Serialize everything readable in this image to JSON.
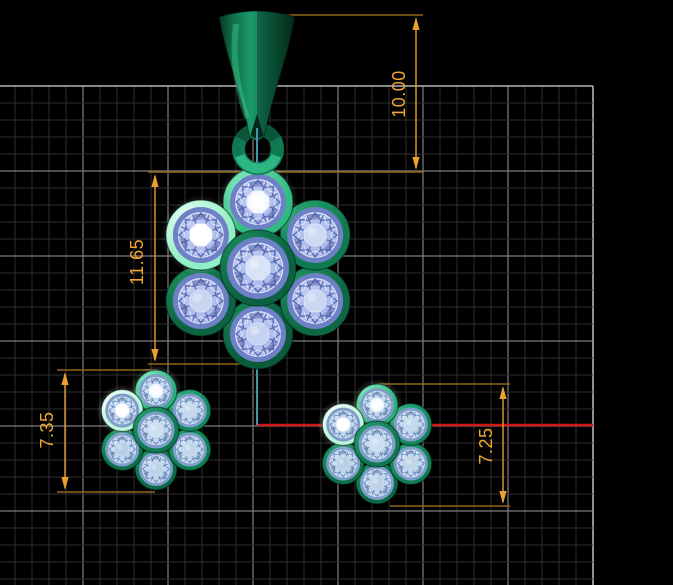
{
  "viewport": {
    "width": 673,
    "height": 585,
    "background": "#000000"
  },
  "grid": {
    "origin_x": -2,
    "origin_y": 86,
    "step": 17,
    "major_every": 5,
    "right_edge": 593,
    "bottom_edge": 585,
    "minor_color": "#2e2e2e",
    "major_color": "#7e7e7e",
    "edge_color": "#b4b4b4"
  },
  "annotations": {
    "dimension_color": "#e9a02c",
    "extension_color": "#8f691c",
    "text_color": "#f2a72f",
    "font_size": 18,
    "dimensions": [
      {
        "id": "bail-height",
        "label": "10.00",
        "line": {
          "x": 416,
          "y1": 17,
          "y2": 170
        },
        "extensions": [
          [
            270,
            15,
            423,
            15
          ]
        ],
        "text": {
          "x": 400,
          "y": 94
        }
      },
      {
        "id": "pendant-height",
        "label": "11.65",
        "line": {
          "x": 155,
          "y1": 174,
          "y2": 362
        },
        "extensions": [
          [
            148,
            172,
            423,
            172
          ],
          [
            148,
            364,
            259,
            364
          ]
        ],
        "text": {
          "x": 138,
          "y": 262
        }
      },
      {
        "id": "left-earring-height",
        "label": "7.35",
        "line": {
          "x": 65,
          "y1": 372,
          "y2": 490
        },
        "extensions": [
          [
            57,
            370,
            158,
            370
          ],
          [
            57,
            492,
            155,
            492
          ]
        ],
        "text": {
          "x": 48,
          "y": 430
        }
      },
      {
        "id": "right-earring-height",
        "label": "7.25",
        "line": {
          "x": 503,
          "y1": 386,
          "y2": 504
        },
        "extensions": [
          [
            377,
            384,
            510,
            384
          ],
          [
            390,
            506,
            510,
            506
          ]
        ],
        "text": {
          "x": 487,
          "y": 446
        }
      }
    ]
  },
  "construction": {
    "red_axis": {
      "x1": 257,
      "x2": 593,
      "y": 425,
      "color": "#d01818",
      "width": 2.4
    },
    "teal_color": "#3f97a8",
    "teal_width": 2,
    "teal_segments": [
      {
        "x": 257,
        "y1": 128,
        "y2": 163
      },
      {
        "x": 257,
        "y1": 366,
        "y2": 425
      }
    ]
  },
  "jewelry": {
    "pendant": {
      "bail": {
        "dark": "#06381f",
        "mid": "#0d6a47",
        "light": "#1b9a6c",
        "notch": "#03271a",
        "shade": "rgba(0,0,0,0.28)",
        "highlight": "rgba(80,220,160,0.35)"
      },
      "ring": {
        "cx": 258,
        "cy": 149,
        "radius": 19.5,
        "tube": 13,
        "base": "#0f7a52",
        "dark_arc": "#0a4c33",
        "light_arc": "#33c18c"
      },
      "palette": {
        "band_id": "band-P",
        "rim": "#6e80c6",
        "band": "#a3b4e8",
        "band_hi": "#bcc9f2",
        "web_dark": "#5a6cb2",
        "web_light": "rgba(238,243,255,0.85)",
        "web_shadow": "#46549e"
      },
      "flower": {
        "cx": 258,
        "cy": 268,
        "petal_distance": 66,
        "petal_bezel_r": 35,
        "petal_gem_r": 28,
        "center_bezel_r": 38,
        "center_gem_r": 31,
        "stones": [
          {
            "name": "bottom",
            "angle": 90,
            "bezel": "#0a5a3b",
            "bezel_hi": "#1c8a5c",
            "table": "#c6d3f0"
          },
          {
            "name": "bottom-right",
            "angle": 30,
            "bezel": "#0d6844",
            "bezel_hi": "#219663",
            "table": "#cbd7f2"
          },
          {
            "name": "bottom-left",
            "angle": 150,
            "bezel": "#0c6341",
            "bezel_hi": "#1f9160",
            "table": "#c9d5f1"
          },
          {
            "name": "top-right",
            "angle": -30,
            "bezel": "#0f7a4f",
            "bezel_hi": "#2aaa72",
            "table": "#cfdaf4"
          },
          {
            "name": "top",
            "angle": -90,
            "bezel": "#2fbc81",
            "bezel_hi": "#8aeec0",
            "table": "#eef3ff",
            "bright": true
          },
          {
            "name": "top-left",
            "angle": -150,
            "bezel": "#8fefc6",
            "bezel_hi": "#eafff4",
            "table": "#ffffff",
            "bright": true
          }
        ],
        "center_stone": {
          "name": "center",
          "bezel": "#0b6243",
          "bezel_hi": "#1e8f60",
          "table": "#d8e2f9"
        }
      }
    },
    "earrings": {
      "palette": {
        "band_id": "band-E",
        "rim": "#7f9fca",
        "band": "#b0c9e6",
        "band_hi": "#cadff4",
        "web_dark": "#6585b5",
        "web_light": "rgba(240,248,255,0.85)",
        "web_shadow": "#55739f"
      },
      "petal_distance": 39,
      "petal_bezel_r": 21,
      "petal_gem_r": 17,
      "center_bezel_r": 23,
      "center_gem_r": 18.5,
      "stones": [
        {
          "name": "bottom",
          "angle": 90,
          "bezel": "#0c6a46",
          "bezel_hi": "#1f9c69",
          "table": "#bdd2e8"
        },
        {
          "name": "bottom-right",
          "angle": 30,
          "bezel": "#0f7e53",
          "bezel_hi": "#27aa75",
          "table": "#c2d6ea"
        },
        {
          "name": "bottom-left",
          "angle": 150,
          "bezel": "#0d7049",
          "bezel_hi": "#22a06c",
          "table": "#b9cfe5"
        },
        {
          "name": "top-right",
          "angle": -30,
          "bezel": "#12875b",
          "bezel_hi": "#30b680",
          "table": "#c6daee"
        },
        {
          "name": "top",
          "angle": -90,
          "bezel": "#28b279",
          "bezel_hi": "#90f0c6",
          "table": "#e9f4ff",
          "bright": true
        },
        {
          "name": "top-left",
          "angle": -150,
          "bezel": "#b9f6da",
          "bezel_hi": "#ffffff",
          "table": "#ffffff",
          "bright": true
        }
      ],
      "center_stone": {
        "name": "center",
        "bezel": "#0f7a52",
        "bezel_hi": "#25a271",
        "table": "#cde0f2"
      },
      "instances": [
        {
          "id": "left-earring",
          "cx": 156,
          "cy": 430
        },
        {
          "id": "right-earring",
          "cx": 377,
          "cy": 444
        }
      ]
    }
  }
}
